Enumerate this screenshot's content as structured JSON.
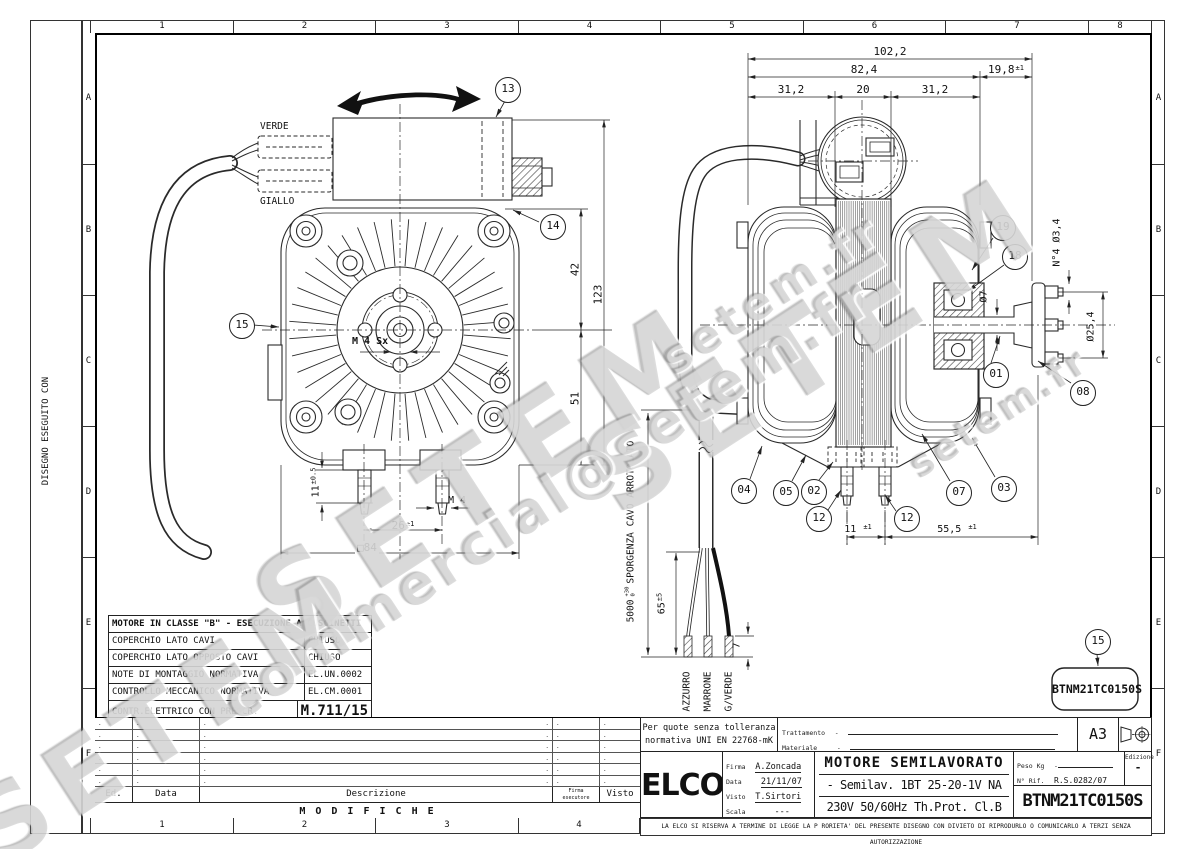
{
  "frame": {
    "top_cols": [
      "1",
      "2",
      "3",
      "4",
      "5",
      "6",
      "7",
      "8"
    ],
    "bottom_cols": [
      "1",
      "2",
      "3",
      "4"
    ],
    "rows": [
      "A",
      "B",
      "C",
      "D",
      "E",
      "F"
    ],
    "margin_note": "DISEGNO ESEGUITO CON"
  },
  "watermark": {
    "big": "SETEM",
    "site": "setem.fr",
    "email": "commercial@setem.fr"
  },
  "front_view": {
    "verde": "VERDE",
    "giallo": "GIALLO",
    "m4sx": "M 4 Sx",
    "c13": "13",
    "c14": "14",
    "c15": "15",
    "d42": "42",
    "d51": "51",
    "d123": "123",
    "d11v": "11",
    "d11t": "±0.5",
    "dm4": "M 4",
    "d26v": "26",
    "d26t": "±1",
    "d84": "□84"
  },
  "side_view": {
    "d102": "102,2",
    "d82": "82,4",
    "d198v": "19,8",
    "d198t": "±1",
    "d31a": "31,2",
    "d20": "20",
    "d31b": "31,2",
    "dia7": "Ø7",
    "n4": "N°4 Ø3,4",
    "dia254": "Ø25,4",
    "d11v": "11",
    "d11t": "±1",
    "d555v": "55,5",
    "d555t": "±1",
    "d5000": "5000",
    "d5000up": "+30",
    "d5000dn": "0",
    "cavo": "SPORGENZA CAVO ARROTOLATO",
    "d65v": "65",
    "d65t": "±5",
    "d7": "7",
    "wire1": "AZZURRO",
    "wire2": "MARRONE",
    "wire3": "G/VERDE",
    "c19": "19",
    "c18": "18",
    "c01": "01",
    "c08": "08",
    "c04": "04",
    "c05": "05",
    "c02": "02",
    "c12a": "12",
    "c12b": "12",
    "c07": "07",
    "c03": "03",
    "c15": "15",
    "part_code": "BTNM21TC0150S"
  },
  "spec_table": {
    "title": "MOTORE IN CLASSE \"B\" - ESECUZIONE A CUSCINETTI",
    "rows": [
      {
        "label": "COPERCHIO LATO CAVI",
        "value": "CHIUSO"
      },
      {
        "label": "COPERCHIO LATO OPPOSTO CAVI",
        "value": "CHIUSO"
      },
      {
        "label": "NOTE DI MONTAGGIO NORMATIVA",
        "value": "EL.UN.0002"
      },
      {
        "label": "CONTROLLO MECCANICO NORMATIVA",
        "value": "EL.CM.0001"
      },
      {
        "label": "CONTR.ELETTRICO CON PRESCR.",
        "value": "M.711/15"
      }
    ]
  },
  "mod_table": {
    "ed": "Ed.",
    "data": "Data",
    "desc": "Descrizione",
    "firma1": "Firma",
    "firma2": "esecutore",
    "visto": "Visto",
    "title": "M O D I F I C H E",
    "dot": "."
  },
  "title_block": {
    "tol1": "Per quote senza tolleranza",
    "tol2": "normativa UNI EN 22768-mK",
    "trattamento": "Trattamento",
    "trattamento_v": "-",
    "materiale": "Materiale",
    "materiale_v": "-",
    "format": "A3",
    "logo": "ELCO",
    "reg": "®",
    "firma_l": "Firma",
    "firma": "A.Zoncada",
    "data_l": "Data",
    "data": "21/11/07",
    "visto_l": "Visto",
    "visto": "T.Sirtori",
    "scala_l": "Scala",
    "scala": "---",
    "title1": "MOTORE SEMILAVORATO",
    "title2": "- Semilav. 1BT 25-20-1V NA",
    "title3": "230V  50/60Hz  Th.Prot. Cl.B",
    "peso_l": "Peso Kg",
    "peso": "-",
    "rif_l": "N° Rif.",
    "rif": "R.S.0282/07",
    "ediz_l": "Edizione",
    "ediz": "-",
    "code": "BTNM21TC0150S",
    "disclaimer": "LA ELCO SI RISERVA A TERMINE DI LEGGE LA P RORIETA' DEL PRESENTE DISEGNO CON DIVIETO DI RIPRODURLO O COMUNICARLO A TERZI SENZA AUTORIZZAZIONE"
  }
}
